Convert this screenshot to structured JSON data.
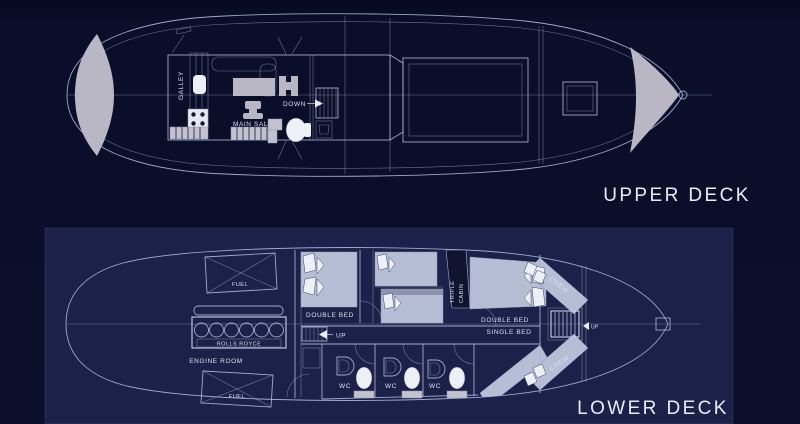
{
  "page": {
    "description": "Yacht deck plans, blueprint style, two decks",
    "colors": {
      "background": "#0b0f2b",
      "panel_background": "#1b2148",
      "line": "#a9b5da",
      "shade_gray": "#b9b7c4",
      "shade_blue": "#b6bed6",
      "white_fill": "#eef0f8",
      "text": "#d9e0f3"
    }
  },
  "upper_deck": {
    "title": "UPPER DECK",
    "labels": {
      "galley": "GALLEY",
      "main_salon": "MAIN SALON",
      "down": "DOWN"
    }
  },
  "lower_deck": {
    "title": "LOWER DECK",
    "labels": {
      "fuel_forward": "FUEL",
      "fuel_aft": "FUEL",
      "rolls_royce": "ROLLS ROYCE",
      "engine_room": "ENGINE ROOM",
      "double_bed_port": "DOUBLE BED",
      "double_bed_starboard": "DOUBLE BED",
      "single_bed": "SINGLE BED",
      "triple_cabin_line1": "TRIPLE",
      "triple_cabin_line2": "CABIN",
      "crew_upper": "CREW",
      "crew_lower": "CREW",
      "up_main": "UP",
      "up_crew": "UP",
      "wc": [
        "WC",
        "WC",
        "WC"
      ]
    }
  }
}
